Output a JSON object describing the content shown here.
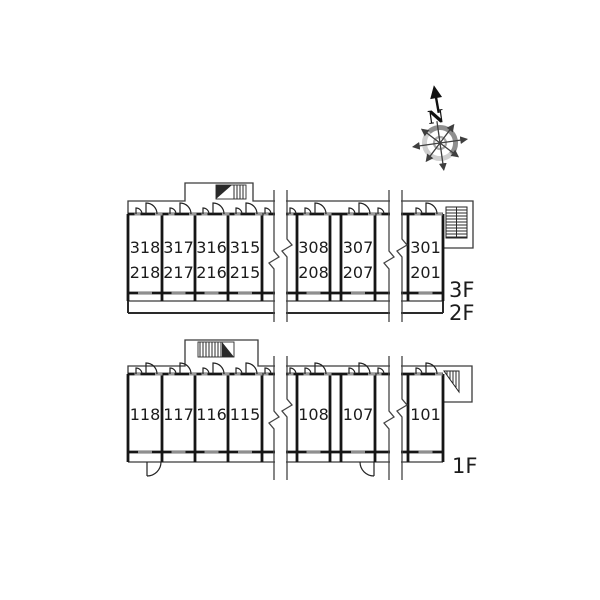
{
  "compass": {
    "north_label": "N"
  },
  "buildings": [
    {
      "name": "upper-floors-plan",
      "floor_labels": [
        "3F",
        "2F"
      ],
      "units": [
        {
          "line1": "318",
          "line2": "218"
        },
        {
          "line1": "317",
          "line2": "217"
        },
        {
          "line1": "316",
          "line2": "216"
        },
        {
          "line1": "315",
          "line2": "215"
        },
        {
          "line1": "308",
          "line2": "208"
        },
        {
          "line1": "307",
          "line2": "207"
        },
        {
          "line1": "301",
          "line2": "201"
        }
      ]
    },
    {
      "name": "first-floor-plan",
      "floor_labels": [
        "1F"
      ],
      "units": [
        {
          "line1": "118"
        },
        {
          "line1": "117"
        },
        {
          "line1": "116"
        },
        {
          "line1": "115"
        },
        {
          "line1": "108"
        },
        {
          "line1": "107"
        },
        {
          "line1": "101"
        }
      ]
    }
  ]
}
